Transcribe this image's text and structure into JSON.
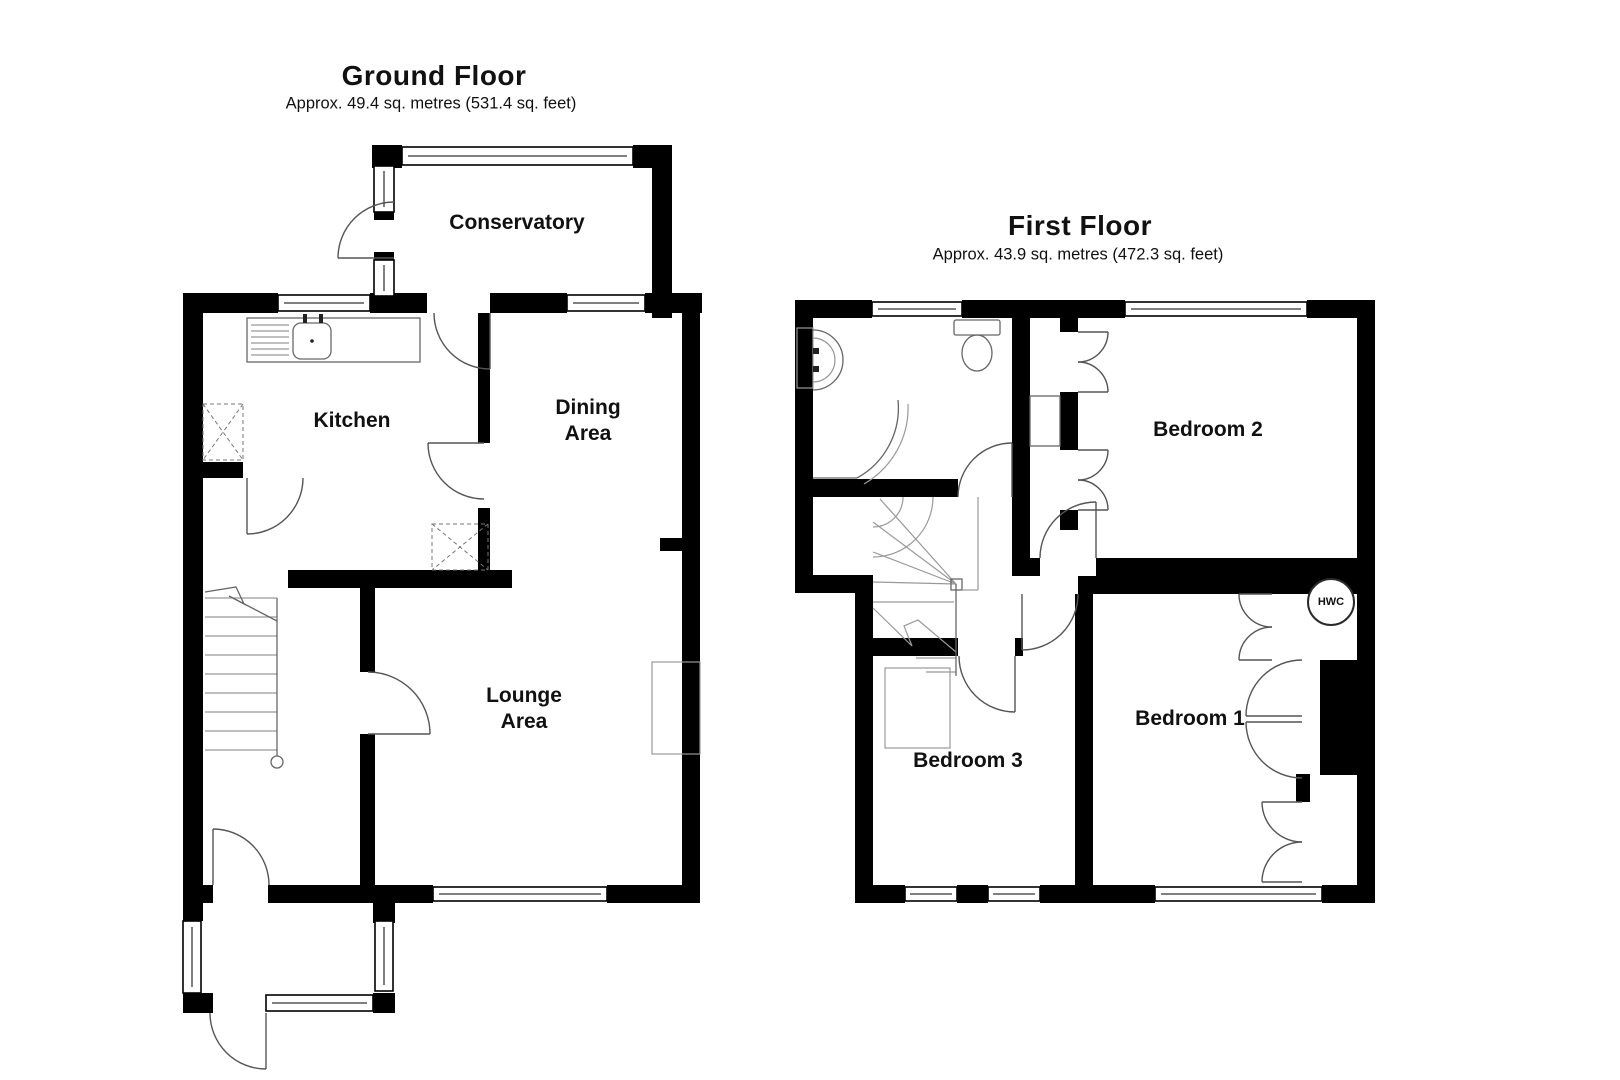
{
  "ground_floor": {
    "title": "Ground Floor",
    "area": "Approx.  49.4 sq. metres (531.4 sq. feet)",
    "rooms": {
      "conservatory": "Conservatory",
      "kitchen": "Kitchen",
      "dining": "Dining\nArea",
      "lounge": "Lounge\nArea"
    }
  },
  "first_floor": {
    "title": "First Floor",
    "area": "Approx.  43.9 sq. metres (472.3 sq. feet)",
    "rooms": {
      "bedroom2": "Bedroom 2",
      "bedroom1": "Bedroom 1",
      "bedroom3": "Bedroom 3"
    },
    "hwc": "HWC"
  }
}
